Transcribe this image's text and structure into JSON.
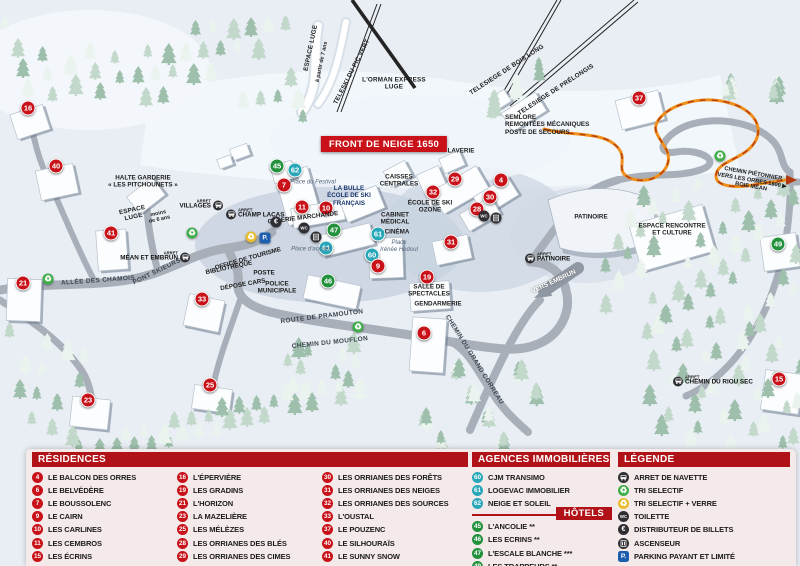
{
  "colors": {
    "marker_red": "#c81118",
    "marker_green": "#21913c",
    "marker_teal": "#28a7b8",
    "header_red": "#b01217",
    "panel_bg": "#f5eaea",
    "banner_red": "#c81118",
    "icon_dark": "#2f2f33",
    "icon_green": "#3fae49",
    "icon_yellow": "#e9bc2f",
    "icon_blue": "#1d5fae"
  },
  "map": {
    "banner": {
      "t": "FRONT DE NEIGE 1650",
      "x": 384,
      "y": 144
    },
    "markers": [
      {
        "n": "16",
        "x": 28,
        "y": 108,
        "c": "red"
      },
      {
        "n": "40",
        "x": 56,
        "y": 166,
        "c": "red"
      },
      {
        "n": "41",
        "x": 111,
        "y": 233,
        "c": "red"
      },
      {
        "n": "21",
        "x": 23,
        "y": 283,
        "c": "red"
      },
      {
        "n": "33",
        "x": 202,
        "y": 299,
        "c": "red"
      },
      {
        "n": "23",
        "x": 88,
        "y": 400,
        "c": "red"
      },
      {
        "n": "25",
        "x": 210,
        "y": 385,
        "c": "red"
      },
      {
        "n": "7",
        "x": 284,
        "y": 185,
        "c": "red"
      },
      {
        "n": "45",
        "x": 277,
        "y": 166,
        "c": "green"
      },
      {
        "n": "62",
        "x": 295,
        "y": 170,
        "c": "teal"
      },
      {
        "n": "11",
        "x": 302,
        "y": 207,
        "c": "red"
      },
      {
        "n": "10",
        "x": 326,
        "y": 208,
        "c": "red"
      },
      {
        "n": "47",
        "x": 334,
        "y": 230,
        "c": "green"
      },
      {
        "n": "61",
        "x": 326,
        "y": 248,
        "c": "teal"
      },
      {
        "n": "61",
        "x": 378,
        "y": 234,
        "c": "teal"
      },
      {
        "n": "60",
        "x": 372,
        "y": 255,
        "c": "teal"
      },
      {
        "n": "9",
        "x": 378,
        "y": 266,
        "c": "red"
      },
      {
        "n": "46",
        "x": 328,
        "y": 281,
        "c": "green"
      },
      {
        "n": "19",
        "x": 427,
        "y": 277,
        "c": "red"
      },
      {
        "n": "29",
        "x": 455,
        "y": 179,
        "c": "red"
      },
      {
        "n": "32",
        "x": 433,
        "y": 192,
        "c": "red"
      },
      {
        "n": "30",
        "x": 490,
        "y": 197,
        "c": "red"
      },
      {
        "n": "28",
        "x": 477,
        "y": 209,
        "c": "red"
      },
      {
        "n": "4",
        "x": 501,
        "y": 180,
        "c": "red"
      },
      {
        "n": "31",
        "x": 451,
        "y": 242,
        "c": "red"
      },
      {
        "n": "6",
        "x": 424,
        "y": 333,
        "c": "red"
      },
      {
        "n": "37",
        "x": 639,
        "y": 98,
        "c": "red"
      },
      {
        "n": "49",
        "x": 778,
        "y": 244,
        "c": "green"
      },
      {
        "n": "15",
        "x": 779,
        "y": 379,
        "c": "red"
      }
    ],
    "labels": [
      {
        "t": "ESPACE LUGE",
        "x": 311,
        "y": 48,
        "r": -78,
        "s": "lift"
      },
      {
        "t": "à partir de 7 ans",
        "x": 322,
        "y": 62,
        "r": -78,
        "s": "lift-sub"
      },
      {
        "t": "TELESKI DU PIC VERT",
        "x": 352,
        "y": 72,
        "r": -63,
        "s": "lift"
      },
      {
        "t": "L'ORMAN EXPRESS\nLUGE",
        "x": 394,
        "y": 84,
        "r": 0,
        "s": "lift"
      },
      {
        "t": "TELESIEGE DE BOIS LONG",
        "x": 507,
        "y": 70,
        "r": -33,
        "s": "lift"
      },
      {
        "t": "TELESIEGE DE PRÉLONGIS",
        "x": 556,
        "y": 90,
        "r": -33,
        "s": "lift"
      },
      {
        "t": "SEMLORE\nREMONTÉES MÉCANIQUES\nPOSTE DE SECOURS",
        "x": 505,
        "y": 125,
        "r": 0,
        "s": "poi",
        "a": "l"
      },
      {
        "t": "LAVERIE",
        "x": 461,
        "y": 151,
        "r": 0,
        "s": "poi"
      },
      {
        "t": "HALTE GARDERIE\n« LES PITCHOUNETS »",
        "x": 143,
        "y": 182,
        "r": 0,
        "s": "poi"
      },
      {
        "t": "ESPACE\nLUGE",
        "x": 133,
        "y": 214,
        "r": -12,
        "s": "lift"
      },
      {
        "t": "moins\nde 6 ans",
        "x": 159,
        "y": 217,
        "r": -12,
        "s": "lift-sub"
      },
      {
        "t": "GALERIE MARCHANDE",
        "x": 303,
        "y": 218,
        "r": -7,
        "s": "poi"
      },
      {
        "t": "LA BULLE\nÉCOLE DE SKI\nFRANÇAIS",
        "x": 349,
        "y": 196,
        "r": 0,
        "s": "poi-blue"
      },
      {
        "t": "Place du Festival",
        "x": 313,
        "y": 183,
        "r": 0,
        "s": "place"
      },
      {
        "t": "CAISSES\nCENTRALES",
        "x": 399,
        "y": 181,
        "r": 0,
        "s": "poi"
      },
      {
        "t": "ÉCOLE DE SKI\nOZONE",
        "x": 430,
        "y": 207,
        "r": 0,
        "s": "poi"
      },
      {
        "t": "CABINET\nMÉDICAL",
        "x": 395,
        "y": 219,
        "r": 0,
        "s": "poi"
      },
      {
        "t": "CINÉMA",
        "x": 397,
        "y": 232,
        "r": 0,
        "s": "poi"
      },
      {
        "t": "Place\nIrénée Hodoul",
        "x": 399,
        "y": 247,
        "r": 0,
        "s": "place"
      },
      {
        "t": "Place d'accueil",
        "x": 311,
        "y": 250,
        "r": 0,
        "s": "place"
      },
      {
        "t": "OFFICE DE TOURISME",
        "x": 248,
        "y": 259,
        "r": -16,
        "s": "poi"
      },
      {
        "t": "BIBLIOTHÈQUE",
        "x": 229,
        "y": 268,
        "r": -12,
        "s": "poi"
      },
      {
        "t": "POSTE",
        "x": 264,
        "y": 273,
        "r": 0,
        "s": "poi"
      },
      {
        "t": "DÉPOSE CARS",
        "x": 243,
        "y": 285,
        "r": -10,
        "s": "poi"
      },
      {
        "t": "POLICE\nMUNICIPALE",
        "x": 277,
        "y": 288,
        "r": 0,
        "s": "poi"
      },
      {
        "t": "ALLÉE DES CHAMOIS",
        "x": 98,
        "y": 281,
        "r": -4,
        "s": "street"
      },
      {
        "t": "PONT SKIEURS",
        "x": 157,
        "y": 272,
        "r": -26,
        "s": "street"
      },
      {
        "t": "ROUTE DE PRAMOUTON",
        "x": 322,
        "y": 317,
        "r": -7,
        "s": "street"
      },
      {
        "t": "CHEMIN DU MOUFLON",
        "x": 330,
        "y": 343,
        "r": -6,
        "s": "street"
      },
      {
        "t": "SALLE DE\nSPECTACLES",
        "x": 429,
        "y": 291,
        "r": 0,
        "s": "poi"
      },
      {
        "t": "GENDARMERIE",
        "x": 438,
        "y": 304,
        "r": 0,
        "s": "poi"
      },
      {
        "t": "CHEMIN DU GRAND CORREAU",
        "x": 474,
        "y": 360,
        "r": 58,
        "s": "street"
      },
      {
        "t": "VERS EMBRUN",
        "x": 554,
        "y": 282,
        "r": -25,
        "s": "street-white"
      },
      {
        "t": "PATINOIRE",
        "x": 591,
        "y": 217,
        "r": 0,
        "s": "poi"
      },
      {
        "t": "ESPACE RENCONTRE\nET CULTURE",
        "x": 672,
        "y": 230,
        "r": 0,
        "s": "poi"
      },
      {
        "t": "CHEMIN PIÉTONNIER\nVERS LES ORRES 1800 ▶\nBOIS MÉAN",
        "x": 752,
        "y": 181,
        "r": 10,
        "s": "poi-small"
      }
    ],
    "bus_stops": [
      {
        "t": "VILLAGES",
        "x": 217,
        "y": 205,
        "side": "left"
      },
      {
        "t": "CHAMP LACAS",
        "x": 232,
        "y": 214,
        "side": "right"
      },
      {
        "t": "MÉAN ET EMBRUN",
        "x": 184,
        "y": 257,
        "side": "left"
      },
      {
        "t": "PATINOIRE",
        "x": 531,
        "y": 258,
        "side": "right"
      },
      {
        "t": "CHEMIN DU RIOU SEC",
        "x": 679,
        "y": 381,
        "side": "right"
      }
    ],
    "icons": [
      {
        "t": "recycle-green",
        "x": 192,
        "y": 233
      },
      {
        "t": "recycle-green",
        "x": 48,
        "y": 279
      },
      {
        "t": "recycle-green",
        "x": 358,
        "y": 327
      },
      {
        "t": "recycle-green",
        "x": 720,
        "y": 156
      },
      {
        "t": "recycle-yellow",
        "x": 251,
        "y": 237
      },
      {
        "t": "parking",
        "x": 265,
        "y": 238
      },
      {
        "t": "euro",
        "x": 276,
        "y": 222
      },
      {
        "t": "wc",
        "x": 304,
        "y": 228
      },
      {
        "t": "elevator",
        "x": 316,
        "y": 237
      },
      {
        "t": "wc",
        "x": 484,
        "y": 216
      },
      {
        "t": "elevator",
        "x": 496,
        "y": 218
      }
    ]
  },
  "panel": {
    "residences": {
      "title": "RÉSIDENCES",
      "items": [
        {
          "n": "4",
          "label": "LE BALCON DES ORRES"
        },
        {
          "n": "6",
          "label": "LE BELVÉDÈRE"
        },
        {
          "n": "7",
          "label": "LE BOUSSOLENC"
        },
        {
          "n": "9",
          "label": "LE CAIRN"
        },
        {
          "n": "10",
          "label": "LES CARLINES"
        },
        {
          "n": "11",
          "label": "LES CEMBROS"
        },
        {
          "n": "15",
          "label": "LES ÉCRINS"
        },
        {
          "n": "16",
          "label": "L'ÉPERVIÈRE"
        },
        {
          "n": "19",
          "label": "LES GRADINS"
        },
        {
          "n": "21",
          "label": "L'HORIZON"
        },
        {
          "n": "23",
          "label": "LA MAZELIÈRE"
        },
        {
          "n": "25",
          "label": "LES MÉLÈZES"
        },
        {
          "n": "28",
          "label": "LES ORRIANES DES BLÉS"
        },
        {
          "n": "29",
          "label": "LES ORRIANES DES CIMES"
        },
        {
          "n": "30",
          "label": "LES ORRIANES DES FORÊTS"
        },
        {
          "n": "31",
          "label": "LES ORRIANES DES NEIGES"
        },
        {
          "n": "32",
          "label": "LES ORRIANES DES SOURCES"
        },
        {
          "n": "33",
          "label": "L'OUSTAL"
        },
        {
          "n": "37",
          "label": "LE POUZENC"
        },
        {
          "n": "40",
          "label": "LE SILHOURAÏS"
        },
        {
          "n": "41",
          "label": "LE SUNNY SNOW"
        }
      ]
    },
    "agencies": {
      "title": "AGENCES IMMOBILIÈRES",
      "items": [
        {
          "n": "60",
          "label": "CJM TRANSIMO"
        },
        {
          "n": "61",
          "label": "LOGEVAC IMMOBILIER"
        },
        {
          "n": "62",
          "label": "NEIGE ET SOLEIL"
        }
      ]
    },
    "hotels": {
      "title": "HÔTELS",
      "items": [
        {
          "n": "45",
          "label": "L'ANCOLIE **"
        },
        {
          "n": "46",
          "label": "LES ECRINS **"
        },
        {
          "n": "47",
          "label": "L'ESCALE BLANCHE ***"
        },
        {
          "n": "49",
          "label": "LES TRAPPEURS **"
        }
      ]
    },
    "legende": {
      "title": "LÉGENDE",
      "items": [
        {
          "icon": "bus",
          "label": "ARRET DE NAVETTE"
        },
        {
          "icon": "recycle-green",
          "label": "TRI SELECTIF"
        },
        {
          "icon": "recycle-yellow",
          "label": "TRI SELECTIF + VERRE"
        },
        {
          "icon": "wc",
          "label": "TOILETTE"
        },
        {
          "icon": "euro",
          "label": "DISTRIBUTEUR DE BILLETS"
        },
        {
          "icon": "elevator",
          "label": "ASCENSEUR"
        },
        {
          "icon": "parking",
          "label": "PARKING PAYANT ET LIMITÉ"
        }
      ]
    }
  }
}
